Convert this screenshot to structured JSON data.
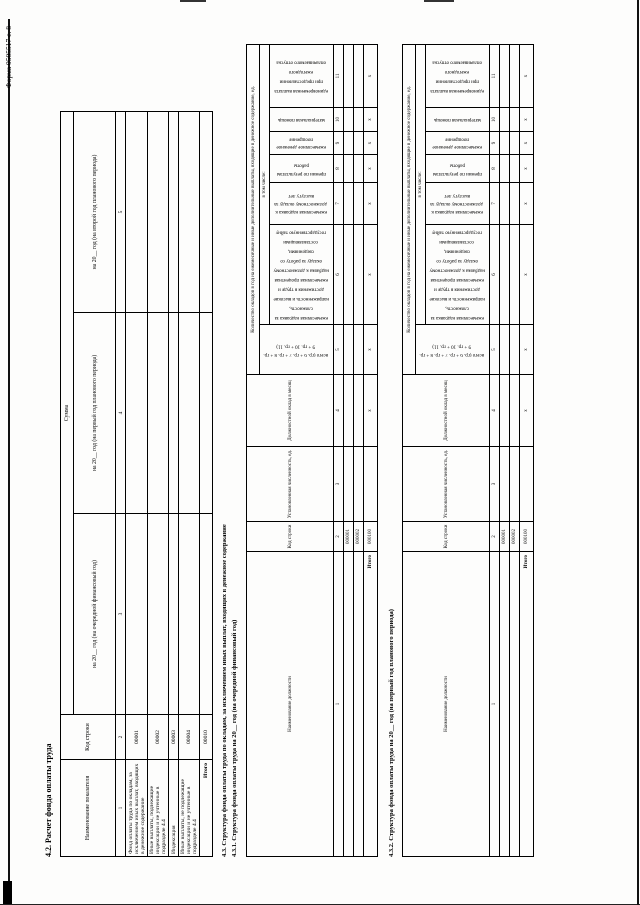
{
  "page": {
    "form_label": "Форма 0505517 с. 8"
  },
  "section_42": {
    "title": "4.2. Расчет фонда оплаты труда",
    "table": {
      "col_indicator": "Наименование показателя",
      "col_code": "Код строки",
      "col_sum": "Сумма",
      "col_year_next": "на 20__ год (на очередной финансовый год)",
      "col_year_plan1": "на 20__ год (на первый год планового периода)",
      "col_year_plan2": "на 20__ год (на второй год планового периода)",
      "nums": [
        "1",
        "2",
        "3",
        "4",
        "5"
      ],
      "rows": [
        {
          "name": "Фонд оплаты труда по окладам, за исключением иных выплат, входящих в денежное содержание",
          "code": "00001"
        },
        {
          "name": "Иные выплаты, подлежащие индексации и не учтенные в подразделе 4.4",
          "code": "00002"
        },
        {
          "name": "Индексация",
          "code": "00003"
        },
        {
          "name": "Иные выплаты, не подлежащие индексации и не учтенные в подразделе 4.4",
          "code": "00004"
        }
      ],
      "total_label": "Итого",
      "total_code": "00010"
    }
  },
  "section_43": {
    "title": "4.3. Структура фонда оплаты труда по окладам, за исключением иных выплат, входящих в денежное содержание"
  },
  "section_431": {
    "title": "4.3.1. Структура фонда оплаты труда на 20__ год (на очередной финансовый год)"
  },
  "section_432": {
    "title": "4.3.2. Структура фонда оплаты труда на 20__ год (на первый год планового периода)"
  },
  "structure_table": {
    "col_position": "Наименование должности",
    "col_code": "Код строки",
    "col_staff": "Установленная численность, ед.",
    "col_salary": "Должностной оклад в месяц",
    "col_group": "Количество окладов в год на ежемесячные и иные дополнительные выплаты, входящие в денежное содержание, ед.",
    "col_total": "всего (гр. 6 + гр. 7 + гр. 8 + гр. 9 + гр. 10 + гр. 11)",
    "col_including": "в том числе:",
    "col_c6": "ежемесячная надбавка за сложность, напряженность и высокие достижения в труде и ежемесячная процентная надбавка к должностному окладу за работу со сведениями, составляющими государственную тайну",
    "col_c7": "ежемесячная надбавка к должностному окладу за выслугу лет",
    "col_c8": "премии по результатам работы",
    "col_c9": "ежемесячное денежное поощрение",
    "col_c10": "материальная помощь",
    "col_c11": "единовременная выплата при предоставлении ежегодного оплачиваемого отпуска",
    "nums": [
      "1",
      "2",
      "3",
      "4",
      "5",
      "6",
      "7",
      "8",
      "9",
      "10",
      "11"
    ],
    "row_codes": [
      "000001",
      "000002"
    ],
    "total_label": "Итого",
    "total_code": "000100",
    "x_mark": "х"
  }
}
